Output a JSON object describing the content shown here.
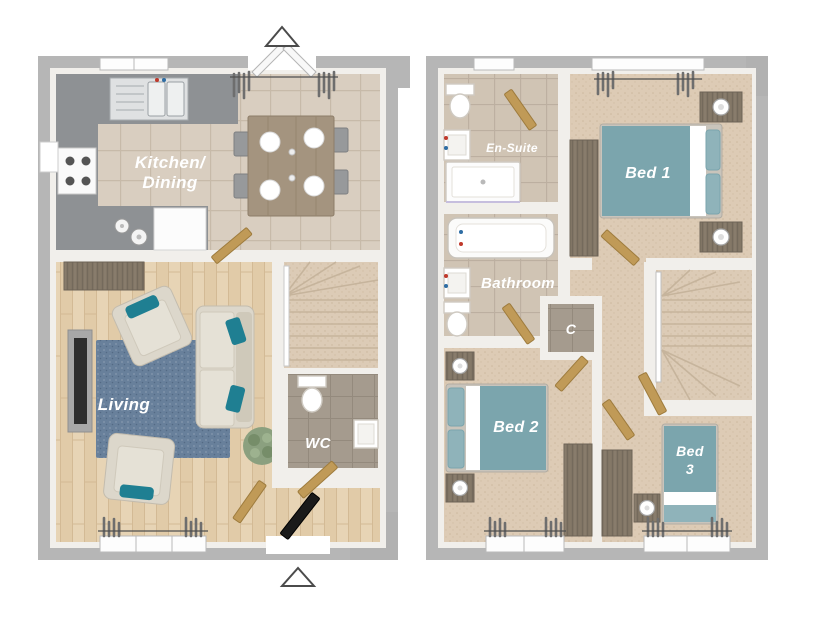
{
  "ground_floor": {
    "rooms": {
      "kitchen_dining": {
        "line1": "Kitchen/",
        "line2": "Dining"
      },
      "living": {
        "label": "Living"
      },
      "wc": {
        "label": "WC"
      }
    }
  },
  "first_floor": {
    "rooms": {
      "en_suite": {
        "label": "En-Suite"
      },
      "bed1": {
        "label": "Bed 1"
      },
      "bathroom": {
        "label": "Bathroom"
      },
      "cupboard": {
        "label": "C"
      },
      "bed2": {
        "label": "Bed 2"
      },
      "bed3": {
        "line1": "Bed",
        "line2": "3"
      }
    }
  },
  "colors": {
    "outer_wall": "#b6b6b6",
    "inner_wall": "#f1efeb",
    "kitchen_tile": "#d9cec0",
    "bathroom_tile": "#d0c4b4",
    "wc_tile": "#a59b8e",
    "wood_floor": "#e7d4b5",
    "carpet": "#ddcbb5",
    "bed_teal": "#7ba5ad",
    "pillow_teal": "#8fb3ba",
    "cushion_teal": "#1f7f92",
    "sofa_cream": "#dcd7cb",
    "rug_blue": "#68809b",
    "door_wood": "#c09a57",
    "dark_wood": "#847867",
    "counter_grey": "#8e9194",
    "label_text": "#ffffff"
  }
}
